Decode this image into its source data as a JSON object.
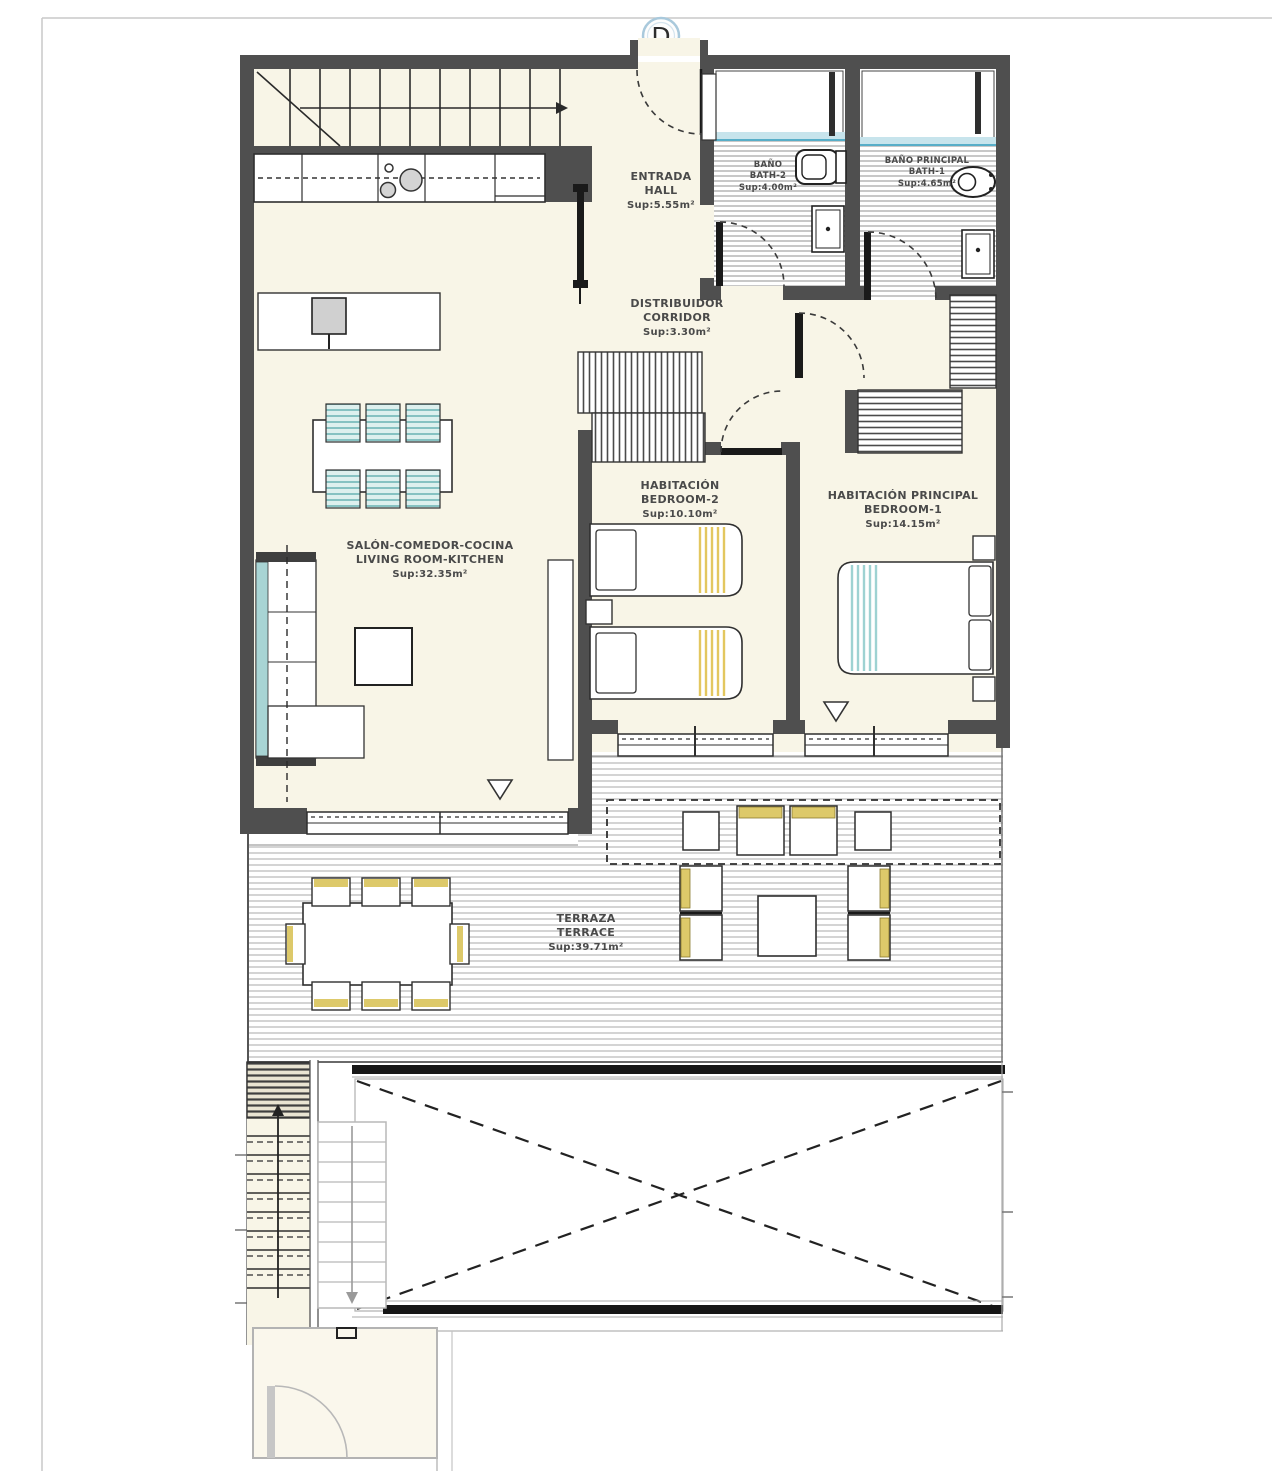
{
  "plan": {
    "unit": "D",
    "hall": {
      "l1": "ENTRADA",
      "l2": "HALL",
      "area": "Sup:5.55m²"
    },
    "bath2": {
      "l1": "BAÑO",
      "l2": "BATH-2",
      "area": "Sup:4.00m²"
    },
    "bath1": {
      "l1": "BAÑO PRINCIPAL",
      "l2": "BATH-1",
      "area": "Sup:4.65m²"
    },
    "corridor": {
      "l1": "DISTRIBUIDOR",
      "l2": "CORRIDOR",
      "area": "Sup:3.30m²"
    },
    "bedroom2": {
      "l1": "HABITACIÓN",
      "l2": "BEDROOM-2",
      "area": "Sup:10.10m²"
    },
    "bedroom1": {
      "l1": "HABITACIÓN PRINCIPAL",
      "l2": "BEDROOM-1",
      "area": "Sup:14.15m²"
    },
    "living": {
      "l1": "SALÓN-COMEDOR-COCINA",
      "l2": "LIVING ROOM-KITCHEN",
      "area": "Sup:32.35m²"
    },
    "terrace": {
      "l1": "TERRAZA",
      "l2": "TERRACE",
      "area": "Sup:39.71m²"
    },
    "colors": {
      "wall": "#4f4f4f",
      "floor_cream": "#f8f5e7",
      "accent_teal": "#a5d5d5",
      "accent_yellow": "#ddc96a",
      "shower_blue": "#c7e4ec",
      "marker_blue": "#a9c9dc"
    }
  }
}
